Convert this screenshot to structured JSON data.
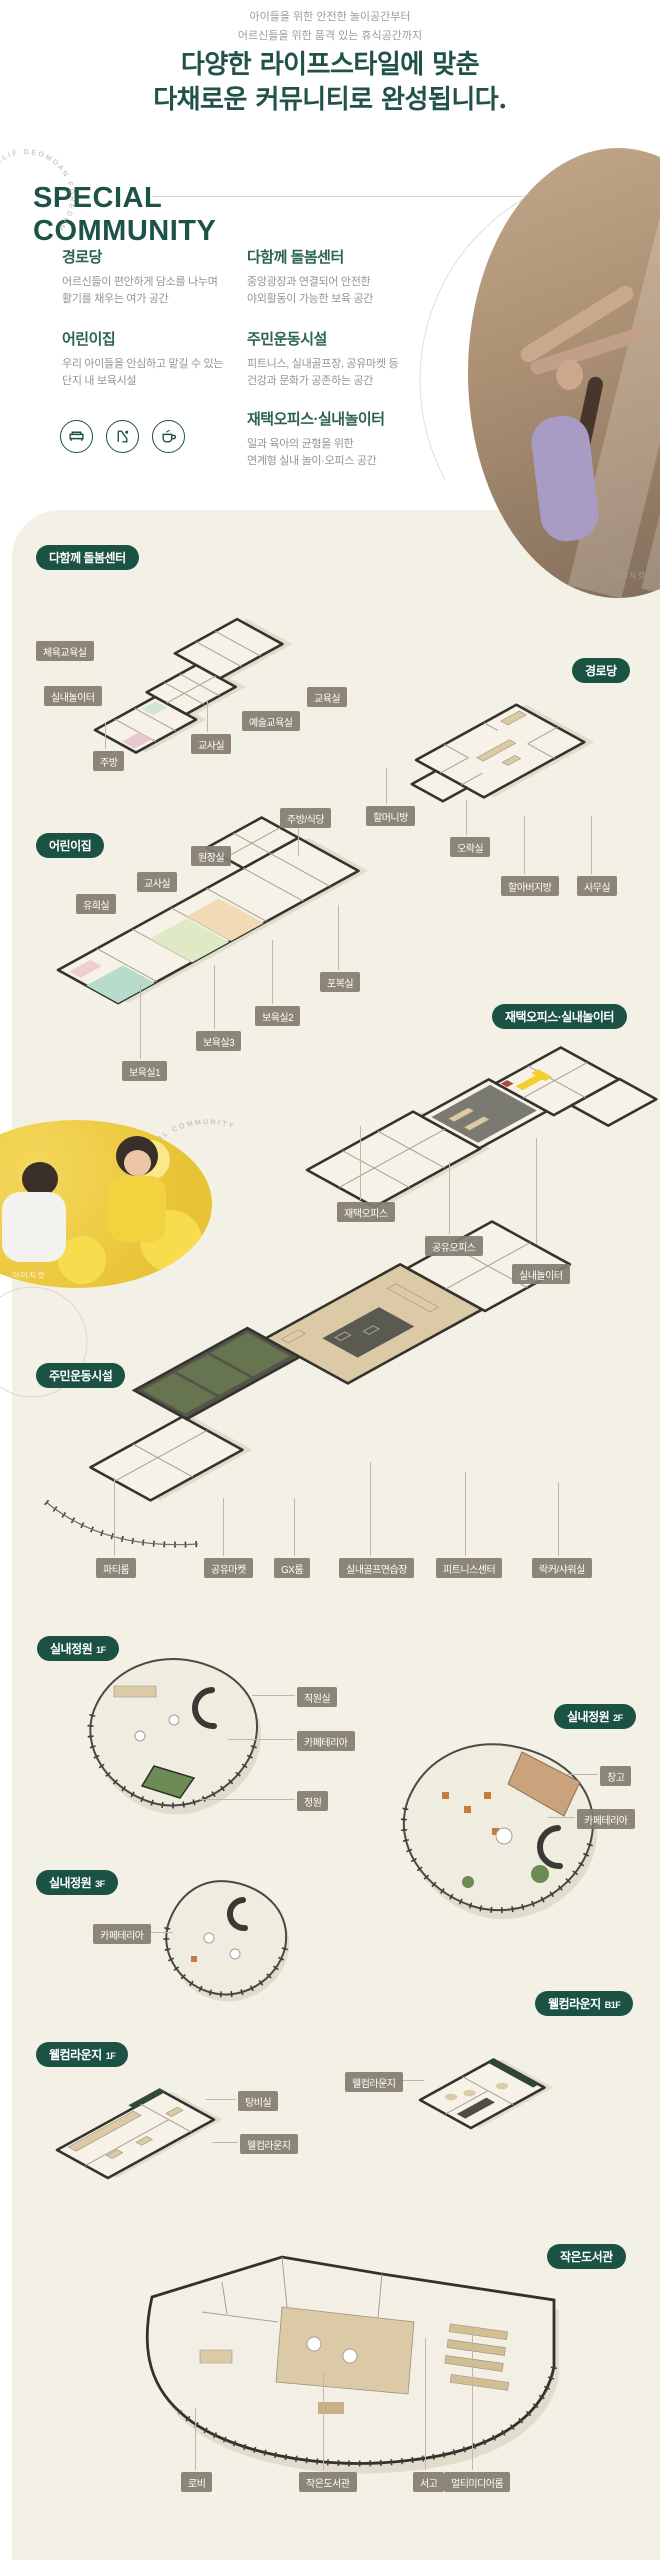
{
  "theme": {
    "brand_green": "#1b5244",
    "panel_beige": "#f3f0e5",
    "label_gray": "#837d70",
    "title_green": "#20524a"
  },
  "header": {
    "subtitle_line1": "아이들을 위한 안전한 놀이공간부터",
    "subtitle_line2": "어르신들을 위한 품격 있는 휴식공간까지",
    "title_line1": "다양한 라이프스타일에 맞춘",
    "title_line2": "다채로운 커뮤니티로 완성됩니다."
  },
  "special": {
    "heading_line1": "SPECIAL",
    "heading_line2": "COMMUNITY",
    "stamp_text": "ELIF GEOMDAN FOREDUM",
    "stamp2_text": "ELIF SPECIAL COMMUNITY",
    "features": [
      {
        "title": "경로당",
        "desc_line1": "어르신들이 편안하게 담소를 나누며",
        "desc_line2": "활기를 채우는 여가 공간"
      },
      {
        "title": "다함께 돌봄센터",
        "desc_line1": "중앙광장과 연결되어 안전한",
        "desc_line2": "야외활동이 가능한 보육 공간"
      },
      {
        "title": "어린이집",
        "desc_line1": "우리 아이들을 안심하고 맡길 수 있는",
        "desc_line2": "단지 내 보육시설"
      },
      {
        "title": "주민운동시설",
        "desc_line1": "피트니스, 실내골프장, 공유마켓 등",
        "desc_line2": "건강과 문화가 공존하는 공간"
      },
      {
        "title": "재택오피스·실내놀이터",
        "desc_line1": "일과 육아의 균형을 위한",
        "desc_line2": "연계형 실내 놀이·오피스 공간"
      }
    ],
    "icon_names": [
      "sofa-icon",
      "slide-icon",
      "coffee-cup-icon"
    ]
  },
  "photos": {
    "yoga_caption": "이미지컷",
    "kids_caption": "이미지컷"
  },
  "plans": {
    "dolbom": {
      "badge": "다함께 돌봄센터",
      "labels": [
        "체육교육실",
        "실내놀이터",
        "교육실",
        "예술교육실",
        "교사실",
        "주방"
      ]
    },
    "gyeongrodang": {
      "badge": "경로당",
      "labels": [
        "할머니방",
        "오락실",
        "할아버지방",
        "사무실"
      ]
    },
    "eorinijip": {
      "badge": "어린이집",
      "labels": [
        "주방/식당",
        "원장실",
        "교사실",
        "유희실",
        "포복실",
        "보육실2",
        "보육실3",
        "보육실1"
      ]
    },
    "office": {
      "badge": "재택오피스·실내놀이터",
      "labels": [
        "재택오피스",
        "공유오피스",
        "실내놀이터"
      ]
    },
    "sports": {
      "badge": "주민운동시설",
      "labels": [
        "파티룸",
        "공유마켓",
        "GX룸",
        "실내골프연습장",
        "피트니스센터",
        "락커/샤워실"
      ]
    },
    "garden1f": {
      "badge": "실내정원",
      "floor": "1F",
      "labels": [
        "직원실",
        "카페테리아",
        "정원"
      ]
    },
    "garden2f": {
      "badge": "실내정원",
      "floor": "2F",
      "labels": [
        "창고",
        "카페테리아"
      ]
    },
    "garden3f": {
      "badge": "실내정원",
      "floor": "3F",
      "labels": [
        "카페테리아"
      ]
    },
    "welcome1f": {
      "badge": "웰컴라운지",
      "floor": "1F",
      "labels": [
        "탕비실",
        "웰컴라운지"
      ]
    },
    "welcomeb1f": {
      "badge": "웰컴라운지",
      "floor": "B1F",
      "labels": [
        "웰컴라운지"
      ]
    },
    "library": {
      "badge": "작은도서관",
      "labels": [
        "로비",
        "작은도서관",
        "서고",
        "멀티미디어룸"
      ]
    }
  }
}
